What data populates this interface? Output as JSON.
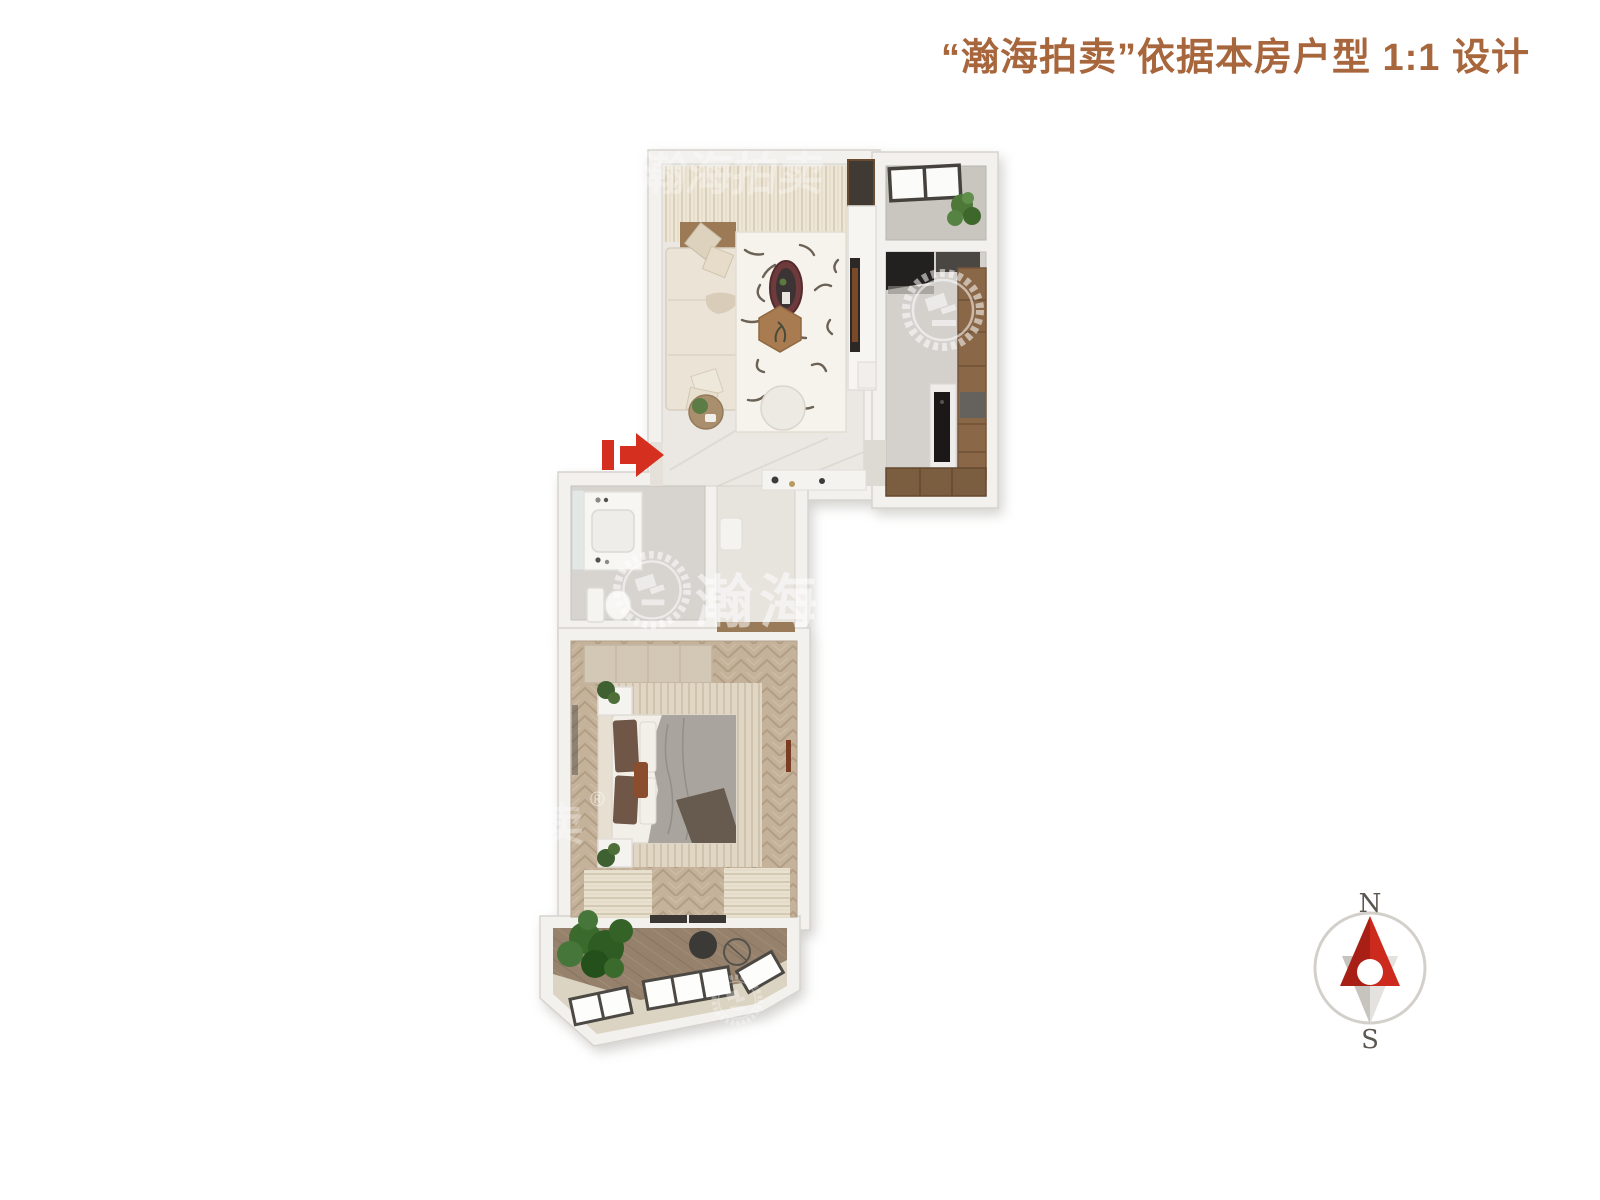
{
  "header": {
    "title": "“瀚海拍卖”依据本房户型 1:1 设计",
    "title_color": "#a8663c"
  },
  "floor_plan": {
    "rooms": [
      "living-room",
      "kitchen",
      "top-balcony",
      "bathroom",
      "hallway",
      "bedroom",
      "south-balcony"
    ],
    "entrance_arrow_color": "#d5301f",
    "wall_color": "#f2f1ee",
    "wood_cabinet_color": "#8a6746"
  },
  "watermark": {
    "brand": "瀚海",
    "brand_partial_top": "瀚海拍卖",
    "brand_partial_side": "卖",
    "registered": "®",
    "color": "#ffffff"
  },
  "compass": {
    "north_label": "N",
    "south_label": "S",
    "north_color": "#cb2a1c",
    "north_shade_color": "#a81f15",
    "south_color": "#e4e2de",
    "south_shade_color": "#c7c4bf",
    "ring_color": "#d3d0cb"
  }
}
